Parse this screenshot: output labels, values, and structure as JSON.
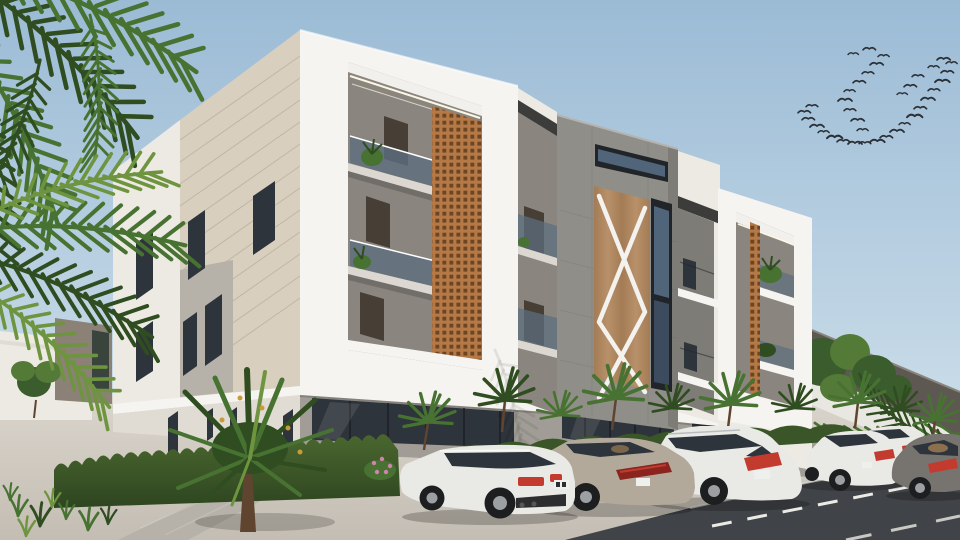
{
  "scene": {
    "title": "Exterior 3D render of a modern three-storey apartment building",
    "description": "White contemporary apartment block with timber X-brace feature tower, terracotta lattice screens, balconies with plants, hedges, palm trees, a flock of birds and a row of parked cars on the street",
    "objects": {
      "palm_foreground": "palm-tree-fronds",
      "bird_flock": "flock-of-birds",
      "building": "apartment-building",
      "tower": "central-stone-tower",
      "x_panel": "timber-x-brace-panel",
      "lattice": "terracotta-lattice-screen",
      "cars": [
        "white-coupe",
        "champagne-sedan",
        "white-suv",
        "white-sedan",
        "white-sedan-far",
        "grey-fastback"
      ],
      "landscape": [
        "hedge",
        "ornamental-shrub",
        "small-palms",
        "flower-bush",
        "grass"
      ],
      "ground": [
        "pavement",
        "paver-walkway",
        "asphalt-road",
        "lane-markings"
      ]
    },
    "palette": {
      "sky_top": "#9bbbd5",
      "sky_horizon": "#cfe0eb",
      "bird": "#2b3036",
      "white_bright": "#f6f4f0",
      "white_wall": "#edeae4",
      "white_shade": "#e0dcd4",
      "beige_panel": "#d8cfbe",
      "beige_groove": "#c0b6a2",
      "grey_panel": "#b6b2aa",
      "tower_grey": "#908e88",
      "tower_dark": "#7e7c76",
      "interior_grey": "#8a867f",
      "interior_dark": "#6e6a64",
      "soffit": "#f2f0ec",
      "slab": "#dcd8d1",
      "door_dark": "#473e35",
      "window_dark": "#2e343b",
      "glass_blue": "#51657a",
      "glass_deep": "#3c4c5e",
      "balcony_glass": "#5c6e7e",
      "lattice": "#b47946",
      "lattice_hole": "#6e4523",
      "wood_a": "#a37b55",
      "wood_b": "#b8906a",
      "brace_white": "#f4f2ee",
      "fascia_dark": "#3c3d3b",
      "frame_black": "#212428",
      "led": "#fdf6e3",
      "base_grey": "#a19d96",
      "hedge_top": "#4a672f",
      "hedge_bot": "#2e4520",
      "strip_green": "#3a5629",
      "leaf_dark": "#2f4d20",
      "leaf_mid": "#477231",
      "leaf_light": "#6f9440",
      "leaf_yellow": "#9aa83e",
      "flower_gold": "#c89a3a",
      "flower_pink": "#d183ad",
      "trunk_brown": "#5f4530",
      "tree_dark": "#3b5c2c",
      "tree_light": "#547a38",
      "wall_dark": "#5d5952",
      "wall_white": "#e9e7e1",
      "bg_box": "#8b8177",
      "bg_window": "#39443d",
      "bg_white": "#eceae3",
      "pave_top": "#dad5cc",
      "pave_bot": "#c3bdb3",
      "paver": "#b7b2a9",
      "road": "#404347",
      "road_line": "#eceae4",
      "curb": "#e5e2da",
      "car_white": "#e9eae6",
      "car_champagne": "#b3a99b",
      "car_dark_grey": "#77746f",
      "tire": "#1c1e20",
      "hub": "#9da0a2",
      "tail_red": "#c23b2e",
      "tail_dark": "#8a241e",
      "plate": "#eef0ee",
      "interior_tan": "#9c7a52",
      "chrome": "#b9bcbe"
    }
  }
}
